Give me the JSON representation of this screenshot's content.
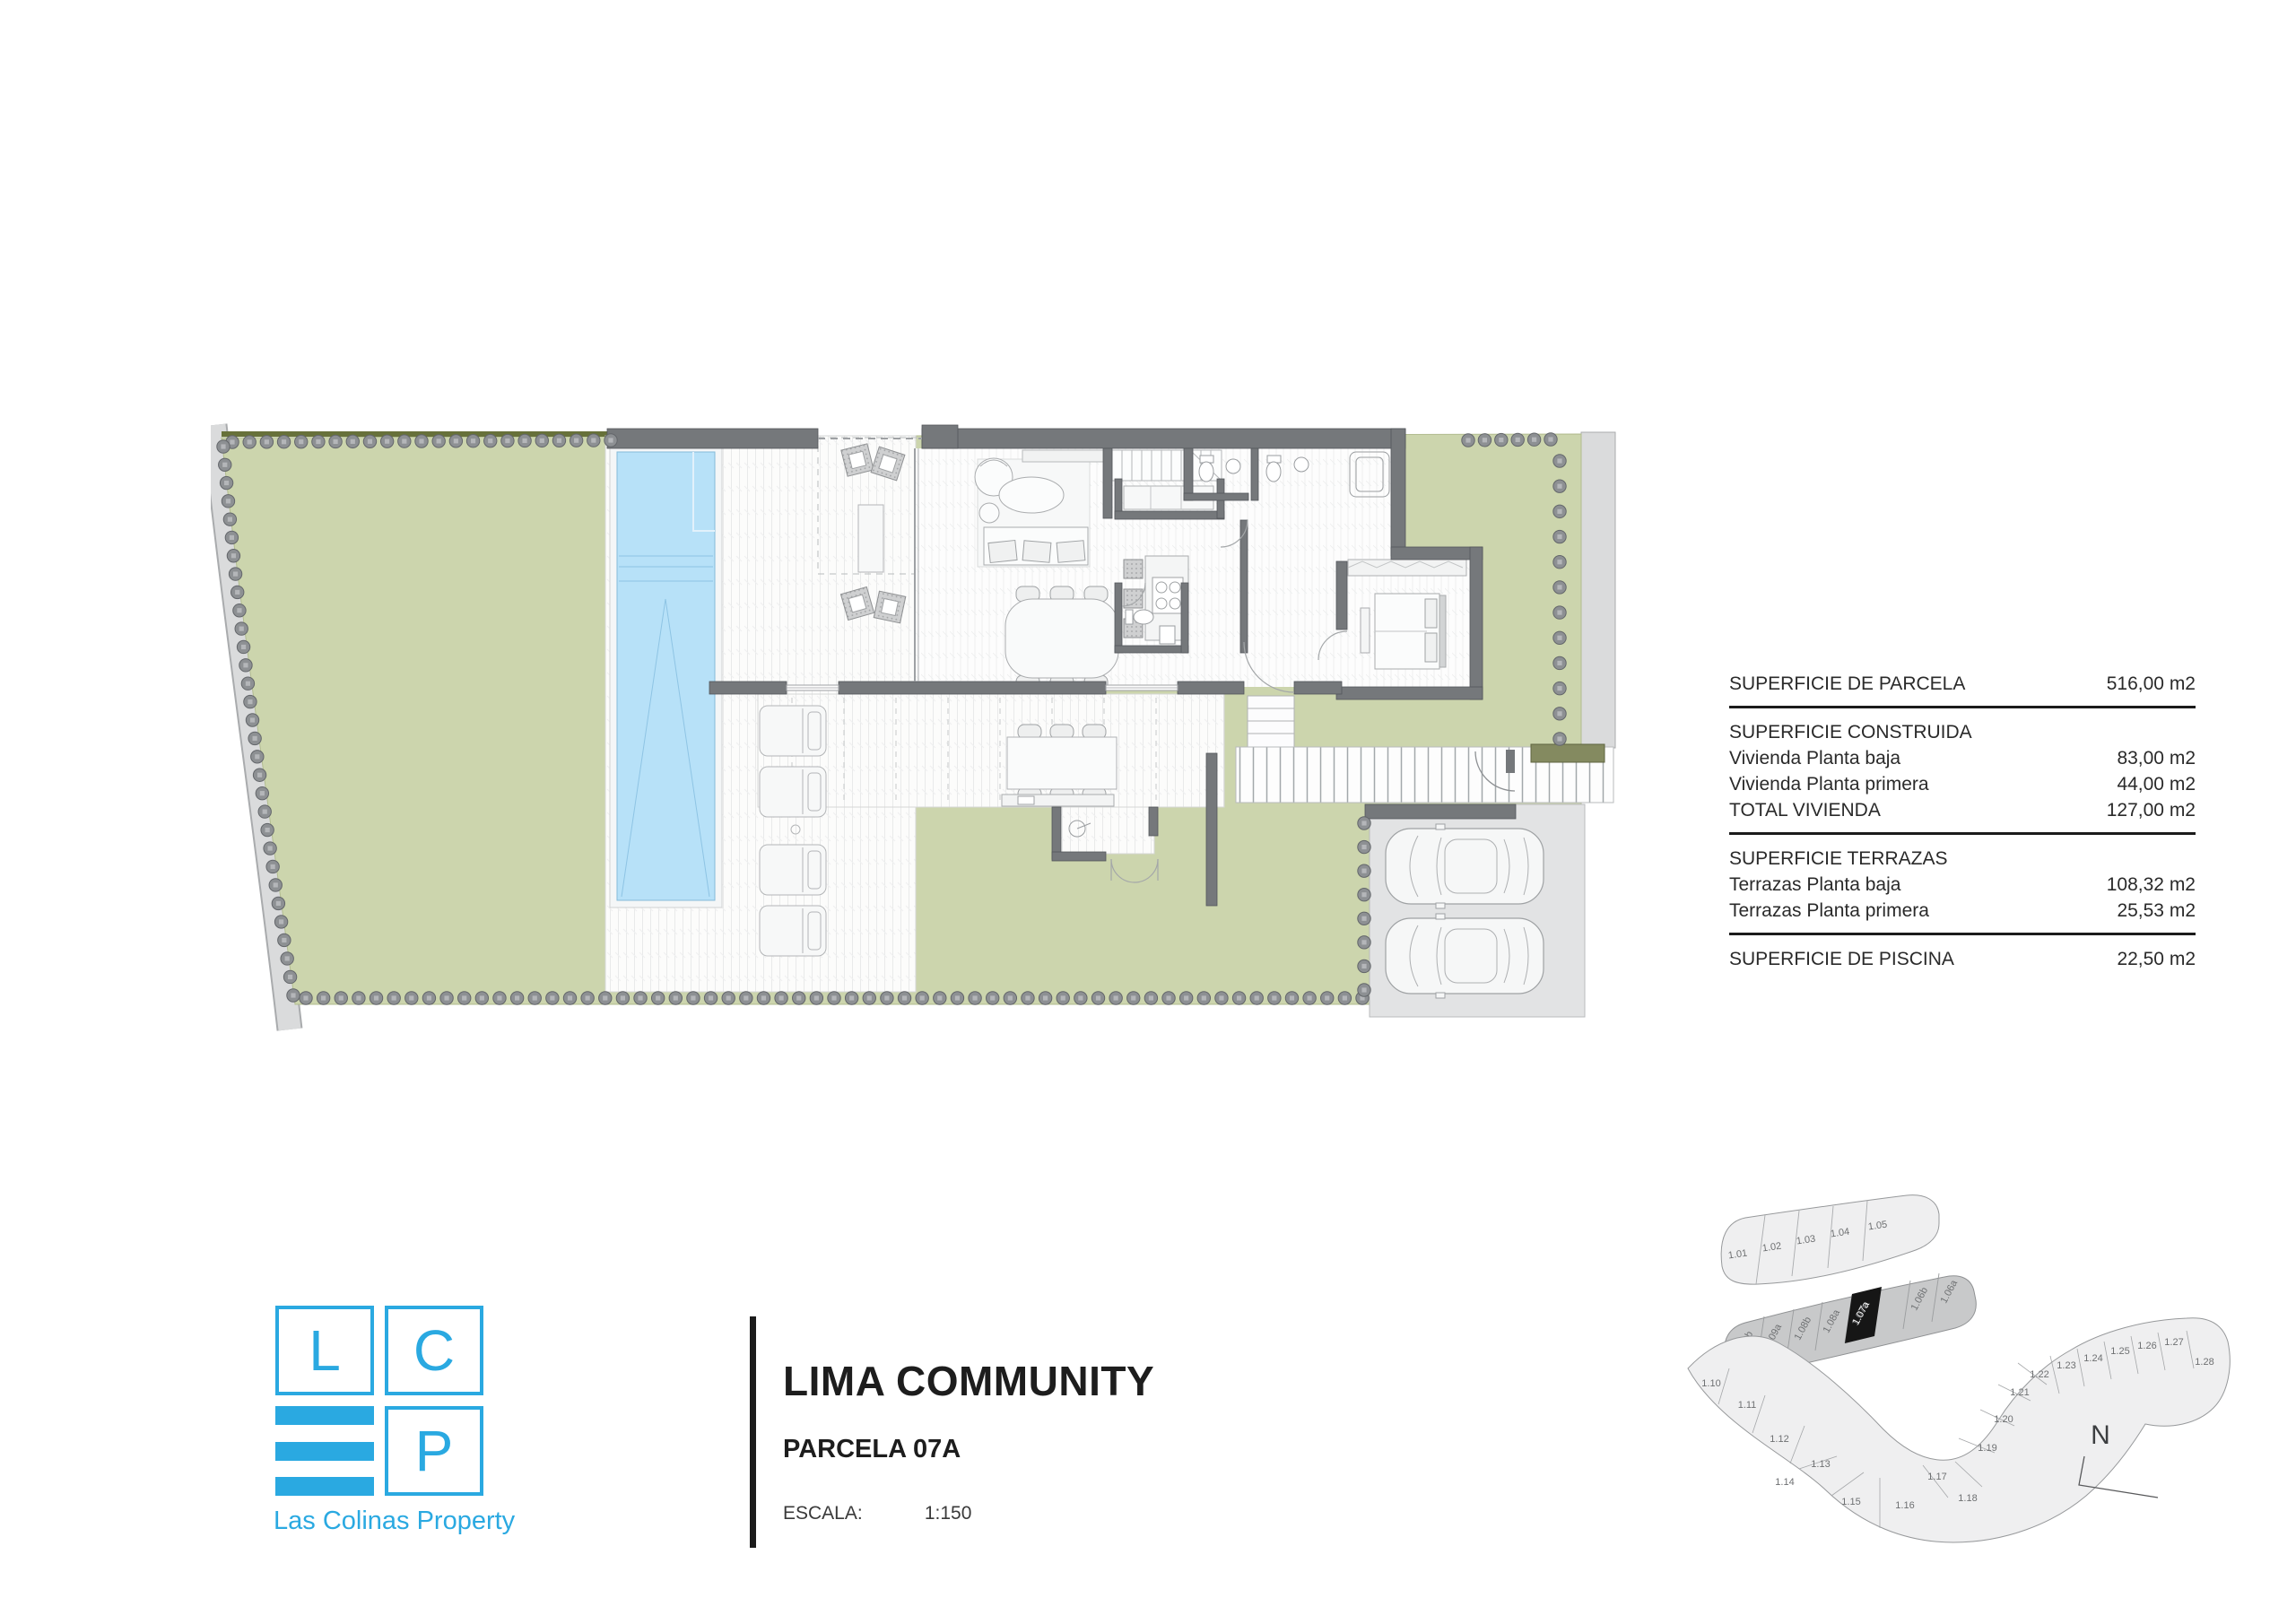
{
  "title_block": {
    "title": "LIMA COMMUNITY",
    "subtitle": "PARCELA 07A",
    "scale_label": "ESCALA:",
    "scale_value": "1:150"
  },
  "logo": {
    "letter_l": "L",
    "letter_c": "C",
    "letter_p": "P",
    "name": "Las Colinas Property",
    "brand_color": "#2aa9e1"
  },
  "surface_table": {
    "rows": [
      {
        "label": "SUPERFICIE DE PARCELA",
        "value": "516,00 m2"
      },
      {
        "label": "SUPERFICIE CONSTRUIDA",
        "value": ""
      },
      {
        "label": "Vivienda Planta baja",
        "value": "83,00 m2"
      },
      {
        "label": "Vivienda Planta primera",
        "value": "44,00 m2"
      },
      {
        "label": "TOTAL VIVIENDA",
        "value": "127,00 m2"
      },
      {
        "label": "SUPERFICIE TERRAZAS",
        "value": ""
      },
      {
        "label": "Terrazas Planta baja",
        "value": "108,32 m2"
      },
      {
        "label": "Terrazas Planta primera",
        "value": "25,53 m2"
      },
      {
        "label": "SUPERFICIE DE PISCINA",
        "value": "22,50 m2"
      }
    ]
  },
  "site_map": {
    "north_label": "N",
    "highlighted_parcel": "1.07a",
    "row_top": [
      "1.01",
      "1.02",
      "1.03",
      "1.04",
      "1.05"
    ],
    "row_mid": [
      "1.09b",
      "1.09a",
      "1.08b",
      "1.08a",
      "1.07b",
      "1.07a",
      "1.06b",
      "1.06a"
    ],
    "ribbon": [
      "1.10",
      "1.11",
      "1.12",
      "1.13",
      "1.14",
      "1.15",
      "1.16",
      "1.17",
      "1.18",
      "1.19",
      "1.20",
      "1.21",
      "1.22",
      "1.23",
      "1.24",
      "1.25",
      "1.26",
      "1.27",
      "1.28"
    ]
  },
  "plan": {
    "colors": {
      "garden_green": "#ccd5ad",
      "pool_blue": "#b7e1f8",
      "wall_gray": "#75787b",
      "path_gray": "#dadbdc",
      "driveway_gray": "#e2e3e4",
      "hedge_dot": "#8d9093",
      "highlight_black": "#161616"
    }
  }
}
